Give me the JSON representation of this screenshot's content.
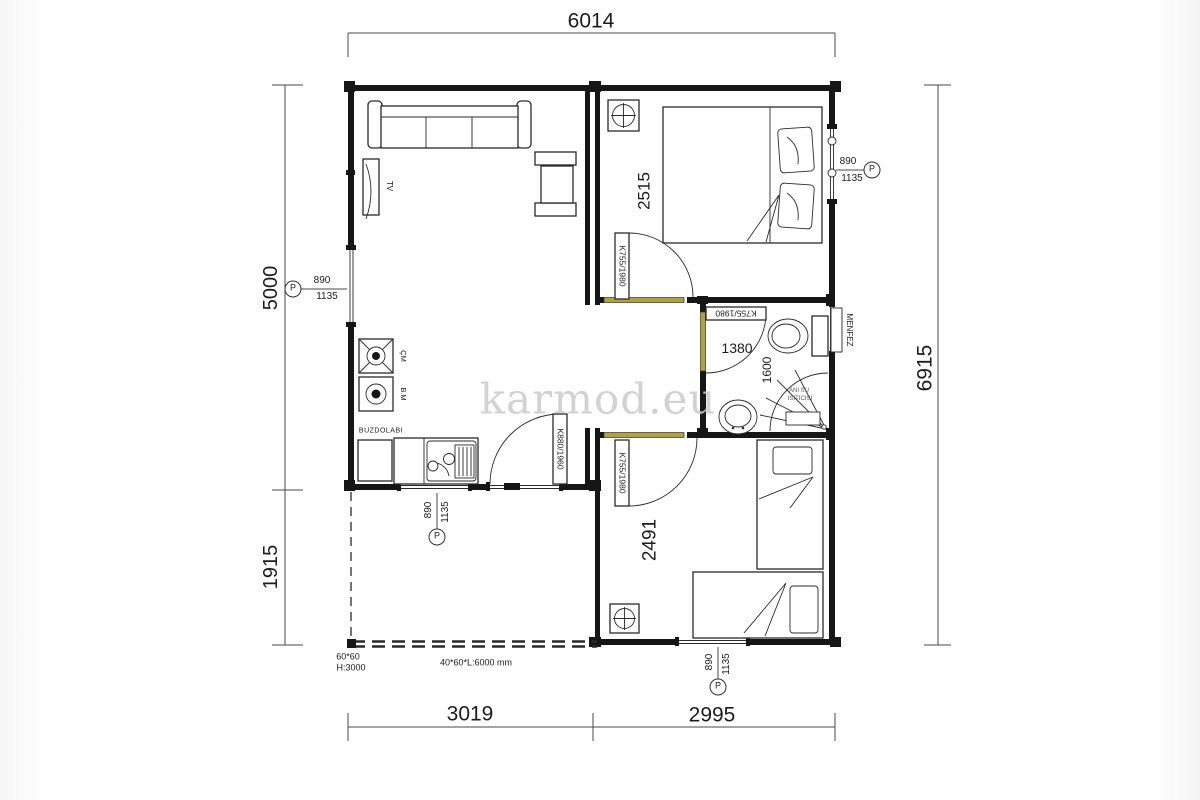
{
  "watermark": "karmod.eu",
  "colors": {
    "threshold": "#b3a23c",
    "watermark_gray": "#cbcbcb",
    "wall": "#161616",
    "line": "#2a2a2a",
    "dim": "#4a4a4a"
  },
  "dims": {
    "top": "6014",
    "right": "6915",
    "left_upper": "5000",
    "left_lower": "1915",
    "bottom_left": "3019",
    "bottom_right": "2995"
  },
  "room_dims": {
    "bedroom1": "2515",
    "bedroom2": "2491",
    "bath_width": "1380",
    "bath_depth": "1600"
  },
  "doors": {
    "entrance": "K880/1960",
    "bedroom1": "K755/1980",
    "bedroom2": "K755/1980",
    "bath": "K755/1980"
  },
  "window_tag": {
    "symbol": "P",
    "num": "890",
    "den": "1135"
  },
  "labels": {
    "tv": "TV",
    "washer": "ÇM",
    "dishwasher": "B.M",
    "fridge": "BUZDOLABI",
    "vent": "MENFEZ",
    "heater_line1": "ANI SU",
    "heater_line2": "ISITICISI",
    "post_size": "60*60",
    "post_height": "H:3000",
    "beam_note": "40*60*L:6000 mm"
  }
}
